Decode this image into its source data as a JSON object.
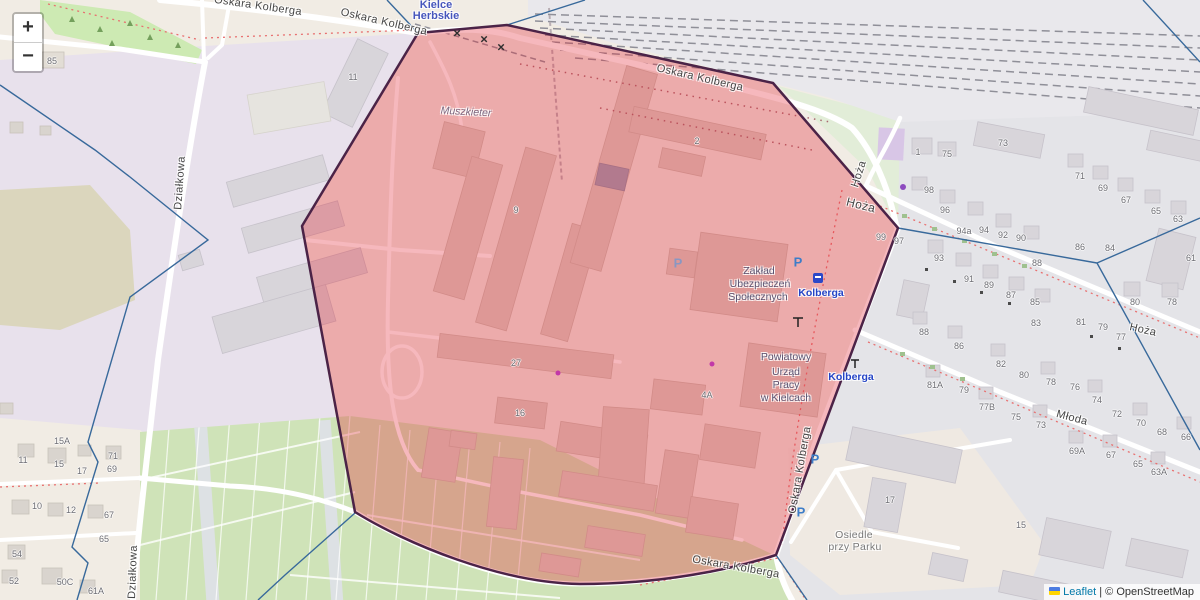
{
  "controls": {
    "zoom_in": "+",
    "zoom_out": "−"
  },
  "attribution": {
    "leaflet": "Leaflet",
    "separator": "|",
    "copyright": "© OpenStreetMap"
  },
  "station": {
    "line1": "Kielce",
    "line2": "Herbskie"
  },
  "streets": {
    "oskara_kolberga": "Oskara Kolberga",
    "hoza": "Hoża",
    "mloda": "Młoda",
    "dzialkowa": "Działkowa"
  },
  "places": {
    "muszkieter": "Muszkieter",
    "zus_line1": "Zakład",
    "zus_line2": "Ubezpieczeń",
    "zus_line3": "Społecznych",
    "pup_line1": "Powiatowy",
    "pup_line2": "Urząd",
    "pup_line3": "Pracy",
    "pup_line4": "w Kielcach",
    "osiedle_line1": "Osiedle",
    "osiedle_line2": "przy Parku",
    "stop_name": "Kolberga"
  },
  "icons": {
    "parking": "P",
    "level_crossing": "×"
  },
  "colors": {
    "selection_fill": "rgba(227,40,56,0.33)",
    "selection_border": "#4b2347",
    "admin_boundary": "#38699b",
    "transit_label": "#2444c6",
    "station_label": "#4756bc",
    "parking_blue": "#3d7dc8"
  },
  "house_numbers": [
    "85",
    "11",
    "9",
    "2",
    "27",
    "16",
    "4A",
    "1",
    "75",
    "73",
    "98",
    "96",
    "94a",
    "94",
    "92",
    "90",
    "99",
    "97",
    "71",
    "69",
    "67",
    "65",
    "63",
    "86",
    "84",
    "88",
    "93",
    "91",
    "89",
    "87",
    "85",
    "80",
    "78",
    "61",
    "88",
    "86",
    "83",
    "81",
    "79",
    "77",
    "82",
    "80",
    "78",
    "76",
    "74",
    "72",
    "70",
    "68",
    "66",
    "81A",
    "79",
    "77B",
    "75",
    "73",
    "69A",
    "67",
    "65",
    "63A",
    "17",
    "15",
    "11",
    "15A",
    "15",
    "17",
    "71",
    "69",
    "10",
    "12",
    "67",
    "65",
    "54",
    "52",
    "50C",
    "61A"
  ]
}
